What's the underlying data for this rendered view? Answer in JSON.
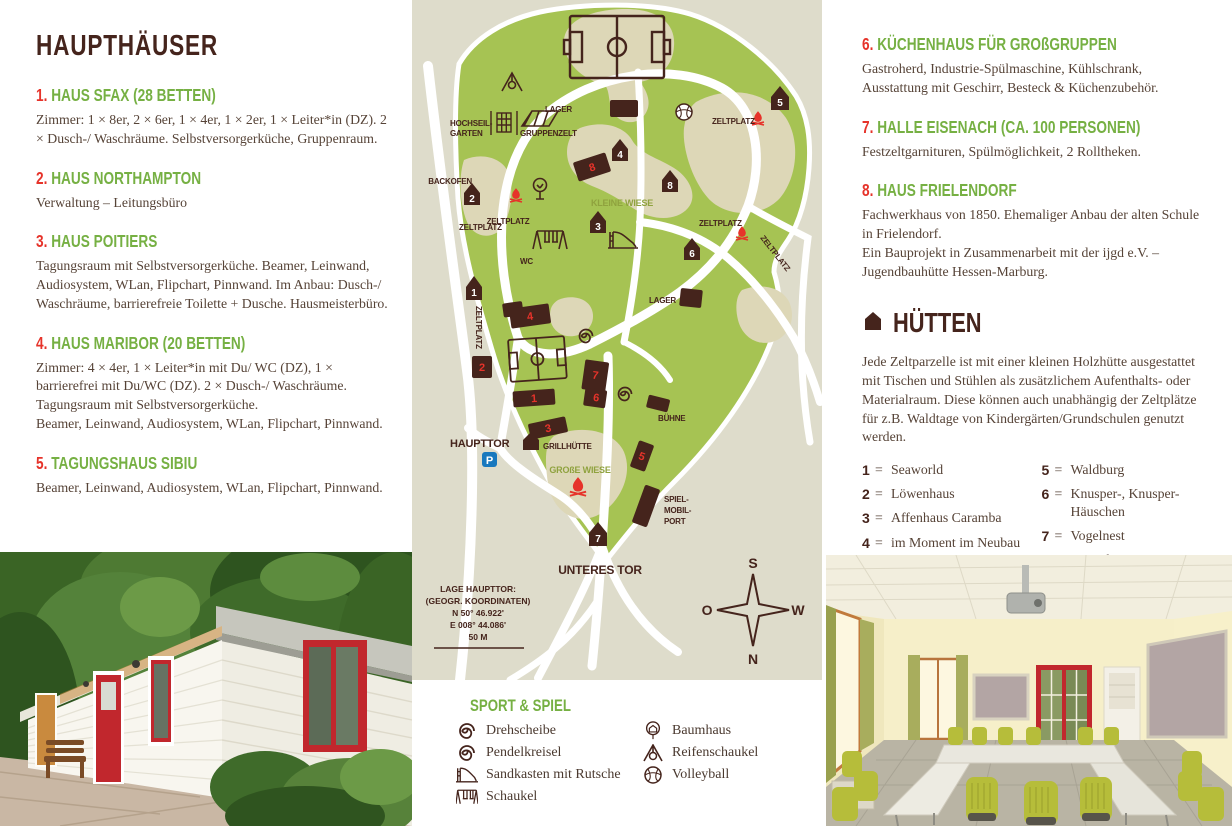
{
  "left_title": "HAUPTHÄUSER",
  "left_items": [
    {
      "num": "1.",
      "title": "HAUS SFAX (28 BETTEN)",
      "body": "Zimmer: 1 × 8er, 2 × 6er, 1 × 4er, 1 × 2er, 1 × Leiter*in (DZ). 2 × Dusch-/ Waschräume. Selbstversorgerküche, Gruppenraum."
    },
    {
      "num": "2.",
      "title": "HAUS NORTHAMPTON",
      "body": "Verwaltung – Leitungsbüro"
    },
    {
      "num": "3.",
      "title": "HAUS POITIERS",
      "body": "Tagungsraum mit Selbstversorgerküche. Beamer, Leinwand, Audiosystem, WLan, Flipchart, Pinnwand. Im Anbau: Dusch-/ Waschräume, barrierefreie Toilette + Dusche. Hausmeisterbüro."
    },
    {
      "num": "4.",
      "title": "HAUS MARIBOR (20 BETTEN)",
      "body": "Zimmer: 4 × 4er, 1 × Leiter*in mit Du/ WC (DZ), 1 × barrierefrei mit Du/WC (DZ). 2 × Dusch-/ Waschräume. Tagungsraum mit Selbstversorgerküche.\nBeamer, Leinwand, Audiosystem, WLan, Flipchart, Pinnwand."
    },
    {
      "num": "5.",
      "title": "TAGUNGSHAUS SIBIU",
      "body": "Beamer, Leinwand, Audiosystem, WLan, Flipchart, Pinnwand."
    }
  ],
  "right_items": [
    {
      "num": "6.",
      "title": "KÜCHENHAUS FÜR GROßGRUPPEN",
      "body": "Gastroherd, Industrie-Spülmaschine, Kühlschrank, Ausstattung mit Geschirr, Besteck & Küchenzubehör."
    },
    {
      "num": "7.",
      "title": "HALLE EISENACH (CA. 100 PERSONEN)",
      "body": "Festzeltgarnituren, Spülmöglichkeit, 2 Rolltheken."
    },
    {
      "num": "8.",
      "title": "HAUS FRIELENDORF",
      "body": "Fachwerkhaus von 1850. Ehemaliger Anbau der alten Schule in Frielendorf.\nEin Bauprojekt in Zusammenarbeit mit der ijgd e.V. – Jugendbauhütte Hessen-Marburg."
    }
  ],
  "huetten": {
    "title": "HÜTTEN",
    "intro": "Jede Zeltparzelle ist mit einer kleinen Holzhütte ausgestattet mit Tischen und Stühlen als zusätzlichem Aufenthalts- oder Materialraum. Diese können auch unabhängig der Zeltplätze für z.B. Waldtage von Kindergärten/Grundschulen genutzt werden.",
    "left": [
      {
        "num": "1",
        "name": "Seaworld"
      },
      {
        "num": "2",
        "name": "Löwenhaus"
      },
      {
        "num": "3",
        "name": "Affenhaus Caramba"
      },
      {
        "num": "4",
        "name": "im Moment im Neubau"
      }
    ],
    "right": [
      {
        "num": "5",
        "name": "Waldburg"
      },
      {
        "num": "6",
        "name": "Knusper-, Knusper-Häuschen"
      },
      {
        "num": "7",
        "name": "Vogelnest"
      },
      {
        "num": "8",
        "name": "Hexenhaus"
      }
    ]
  },
  "map": {
    "labels": {
      "hochseil1": "HOCHSEIL-",
      "hochseil2": "GARTEN",
      "gruppenzelt": "GRUPPENZELT",
      "lager": "LAGER",
      "zeltplatz": "ZELTPLATZ",
      "backofen": "BACKOFEN",
      "kleine_wiese": "KLEINE WIESE",
      "wc": "WC",
      "buehne": "BÜHNE",
      "haupttor": "HAUPTTOR",
      "grillhuette": "GRILLHÜTTE",
      "grosse_wiese": "GROßE WIESE",
      "spielmobil1": "SPIEL-",
      "spielmobil2": "MOBIL-",
      "spielmobil3": "PORT",
      "unteres_tor": "UNTERES TOR",
      "parking": "P"
    },
    "coords": [
      "LAGE HAUPTTOR:",
      "(GEOGR. KOORDINATEN)",
      "N 50° 46.922'",
      "E 008° 44.086'",
      "50 M"
    ],
    "compass": {
      "top": "S",
      "left": "O",
      "right": "W",
      "bottom": "N"
    },
    "building_numbers": [
      "1",
      "2",
      "3",
      "4",
      "5",
      "6",
      "7",
      "8"
    ],
    "hut_numbers": [
      "1",
      "2",
      "3",
      "4",
      "5",
      "6",
      "7",
      "8"
    ],
    "colors": {
      "ground": "#dedccb",
      "grass": "#a6c353",
      "clearing": "#ddd7b7",
      "dark": "#45241c",
      "red": "#e6332a",
      "parking_blue": "#1878be"
    }
  },
  "legend": {
    "title": "SPORT & SPIEL",
    "left": [
      {
        "icon": "spiral-icon",
        "label": "Drehscheibe"
      },
      {
        "icon": "spiral-icon",
        "label": "Pendelkreisel"
      },
      {
        "icon": "slide-icon",
        "label": "Sandkasten mit Rutsche"
      },
      {
        "icon": "swing-icon",
        "label": "Schaukel"
      }
    ],
    "right": [
      {
        "icon": "treehouse-icon",
        "label": "Baumhaus"
      },
      {
        "icon": "tire-swing-icon",
        "label": "Reifenschaukel"
      },
      {
        "icon": "volleyball-icon",
        "label": "Volleyball"
      }
    ]
  },
  "photos": {
    "left_alt": "Weißes Holzhaus mit roten Türen und Fenstern",
    "right_alt": "Tagungsraum mit Tischen und grünen Stühlen"
  }
}
